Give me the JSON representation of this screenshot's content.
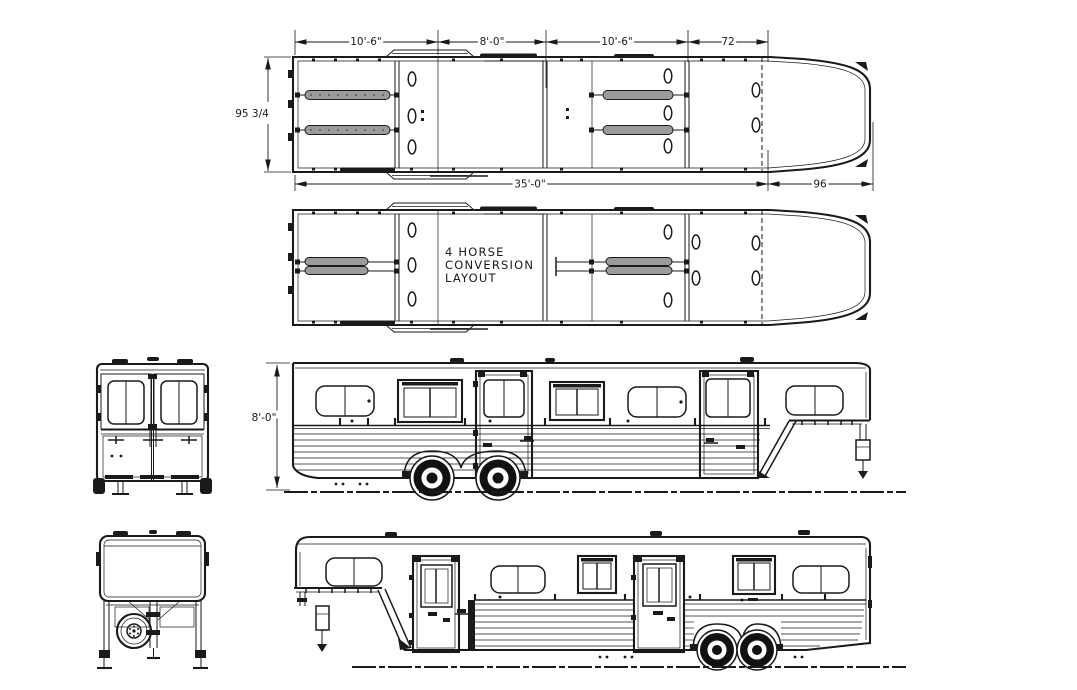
{
  "drawing": {
    "conversion_label": {
      "line1": "4  HORSE",
      "line2": "CONVERSION",
      "line3": "LAYOUT"
    },
    "dimensions": {
      "plan_top_bay1": "10'-6\"",
      "plan_top_bay2": "8'-0\"",
      "plan_top_bay3": "10'-6\"",
      "plan_top_bay4": "72",
      "plan_width": "95 3/4",
      "plan_body_length": "35'-0\"",
      "plan_gooseneck_length": "96",
      "side_height": "8'-0\""
    },
    "colors": {
      "line": "#1a1a1a",
      "divider_fill": "#9b9b9b",
      "background": "#ffffff"
    }
  }
}
